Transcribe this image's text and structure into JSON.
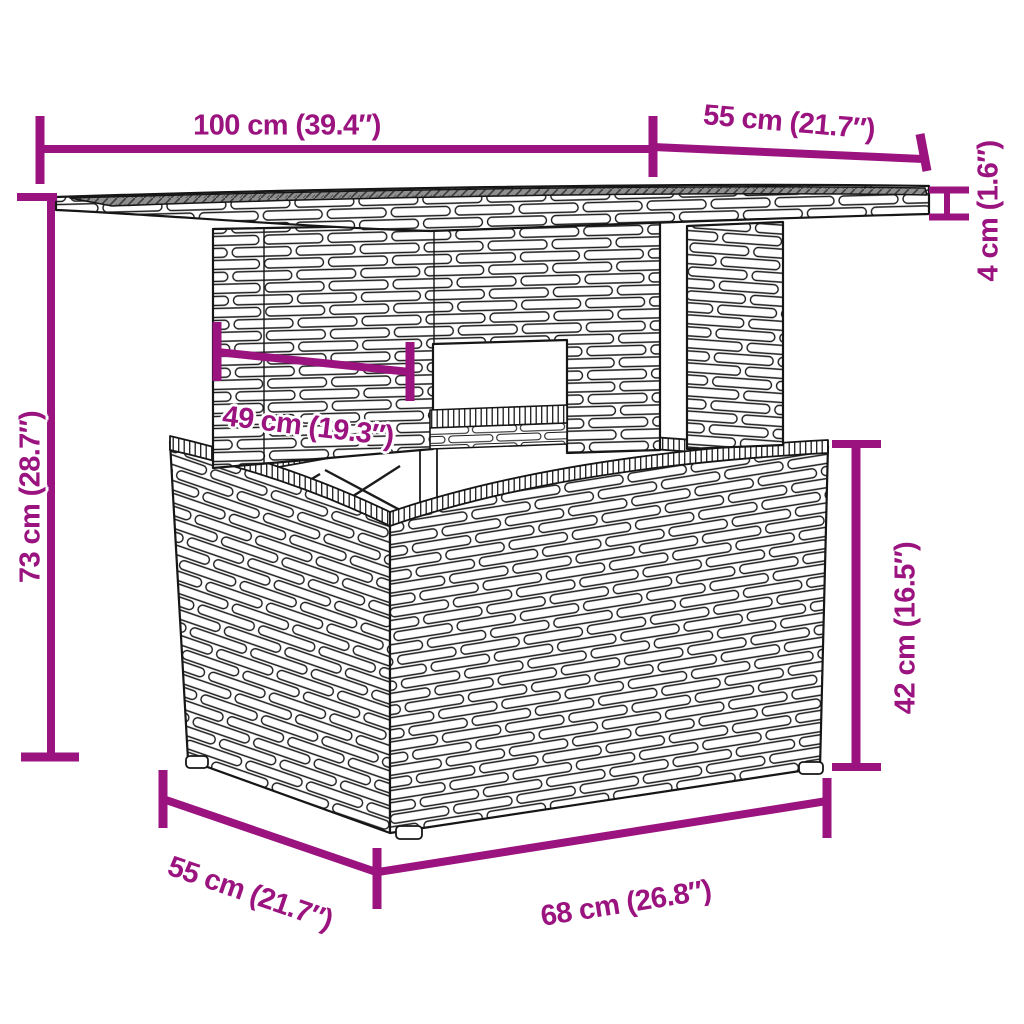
{
  "diagram": {
    "kind": "furniture-dimension-diagram",
    "dimensions": {
      "tabletop_width": "100 cm (39.4″)",
      "tabletop_depth": "55 cm (21.7″)",
      "tabletop_thickness": "4 cm (1.6″)",
      "overall_height": "73 cm (28.7″)",
      "understructure_width": "49 cm (19.3″)",
      "base_height": "42 cm (16.5″)",
      "base_depth": "55 cm (21.7″)",
      "base_width": "68 cm (26.8″)"
    }
  },
  "colors": {
    "accent": "#9A137F",
    "line_art": "#1c1c1c",
    "glass_top": "#8f8f8f",
    "background": "#ffffff"
  }
}
